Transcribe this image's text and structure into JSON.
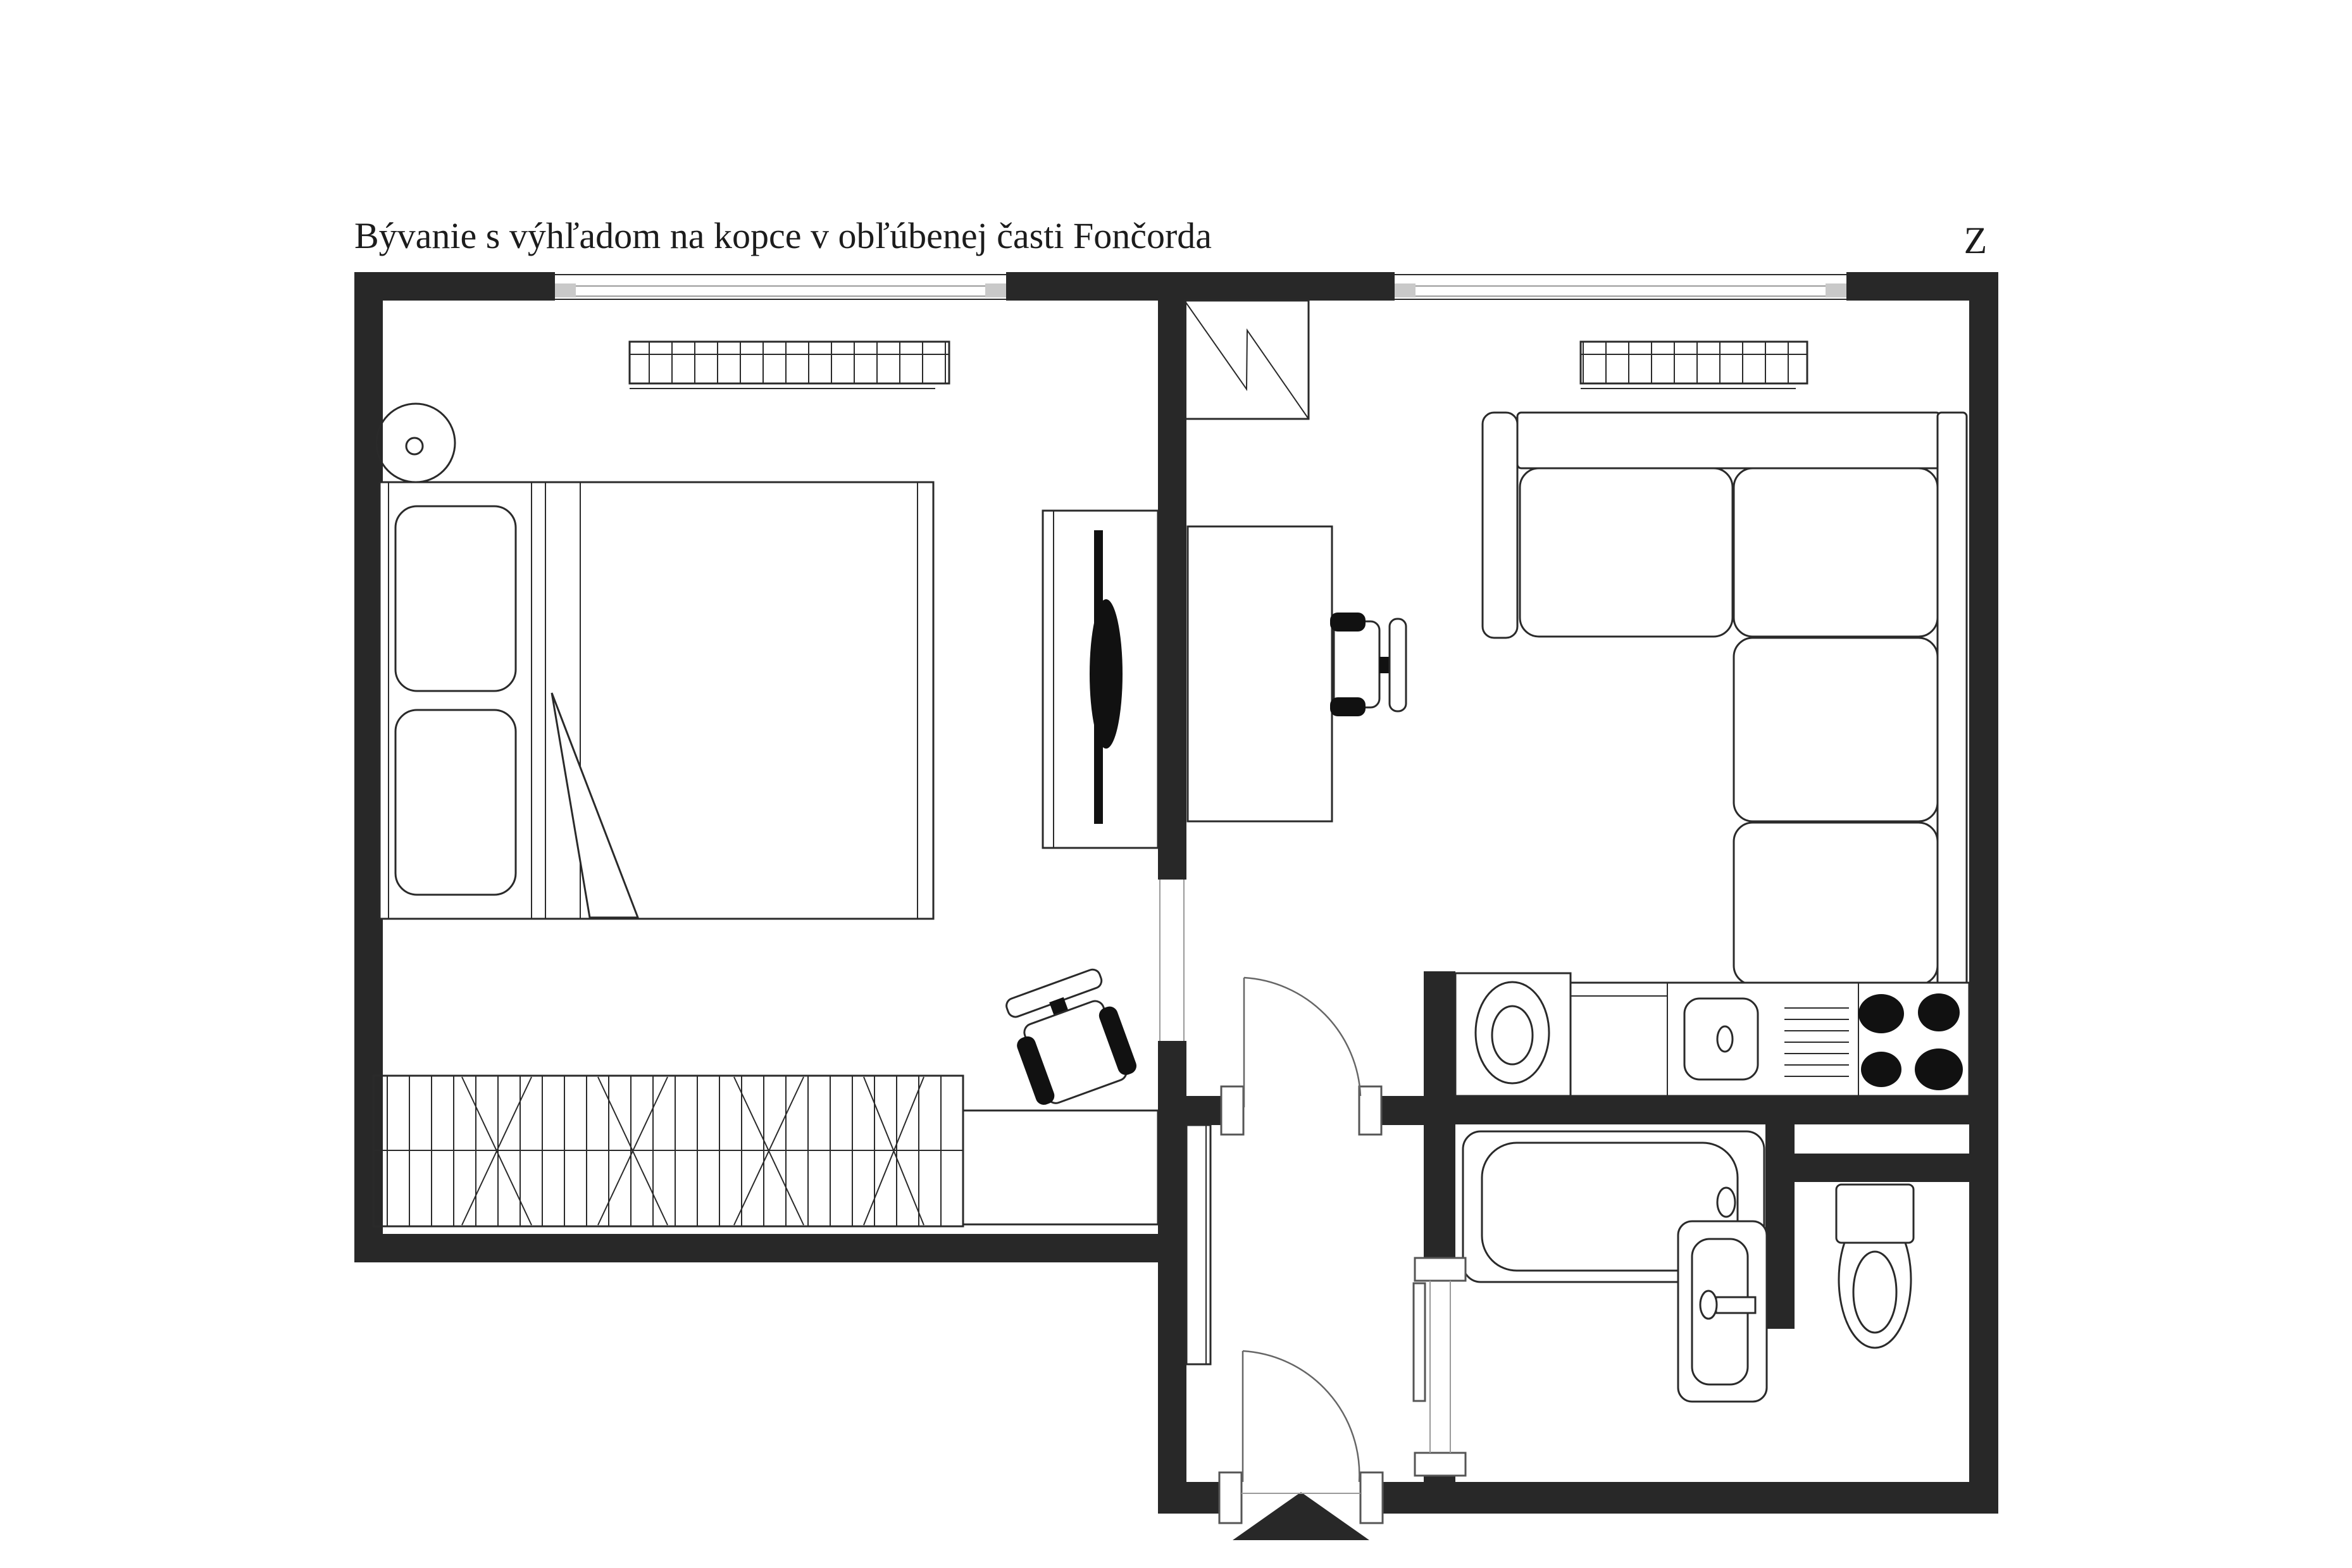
{
  "plan": {
    "title": "Bývanie s výhľadom na kopce v obľúbenej časti Fončorda",
    "compass": "Z",
    "colors": {
      "bg": "#ffffff",
      "wall": "#282828",
      "line": "#2a2a2a",
      "thin": "#9a9a9a",
      "fixture": "#111111",
      "cap": "#c9c9c9"
    },
    "rooms": {
      "bedroom": {
        "items": [
          "ceiling-light",
          "double-bed",
          "pillows",
          "duvet-fold",
          "wardrobe-with-clothes",
          "radiator",
          "window",
          "tv-sideboard",
          "tv",
          "desk",
          "office-chair"
        ]
      },
      "living_room": {
        "items": [
          "window",
          "radiator",
          "closet-symbol",
          "desk",
          "office-chair",
          "corner-sofa",
          "door-to-hall"
        ]
      },
      "kitchen": {
        "items": [
          "washing-machine",
          "countertop",
          "sink",
          "faucet",
          "drainer",
          "cooktop-4-burners"
        ]
      },
      "hall": {
        "items": [
          "shoe-cabinet",
          "entrance-door",
          "entrance-arrow"
        ]
      },
      "bathroom": {
        "items": [
          "bathtub",
          "drain",
          "washbasin",
          "door"
        ]
      },
      "wc": {
        "items": [
          "toilet"
        ]
      }
    }
  }
}
